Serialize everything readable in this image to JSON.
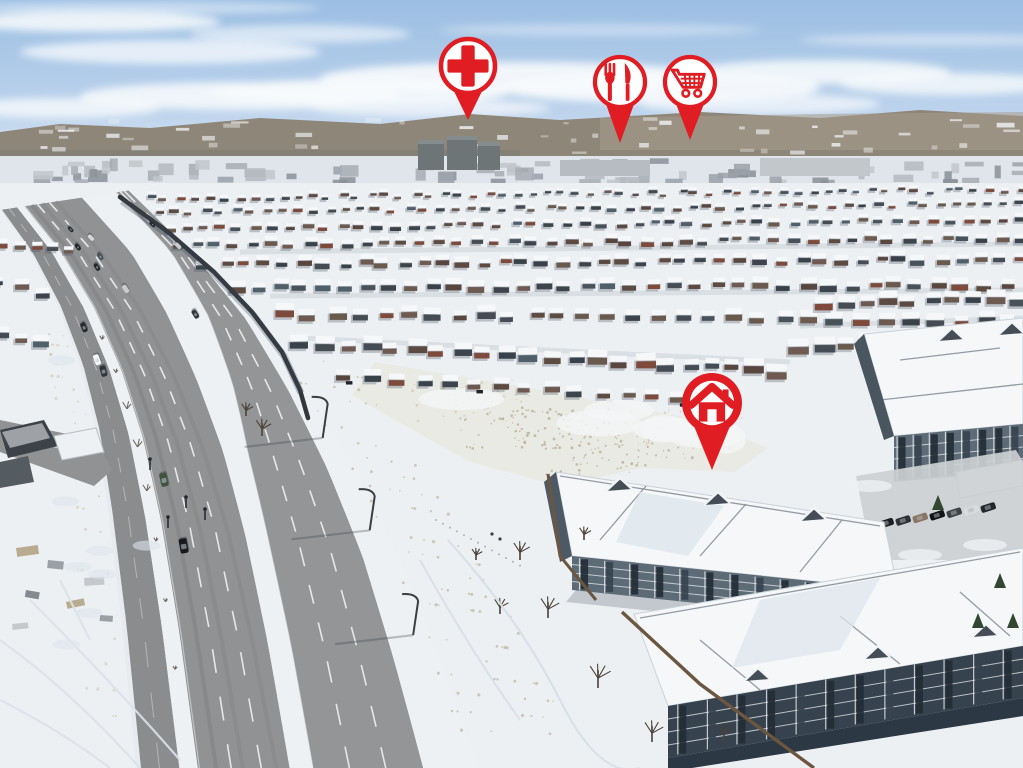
{
  "scene": {
    "type": "aerial-drone-photo",
    "description": "Winter aerial view of a snow-covered suburban neighbourhood: a multi-lane divided arterial road runs diagonally on the left, dense rows of snow-capped houses fill the midground below distant hills, an open snowy field sits in the centre, and three-storey condominium buildings occupy the lower right. Red location marker pins highlight nearby amenities and the featured home.",
    "season": "winter",
    "sky": "clear blue with thin white clouds"
  },
  "overlay": {
    "pin_color": "#e01d23",
    "pin_inner_color": "#ffffff",
    "pins": [
      {
        "name": "hospital-pin",
        "icon": "medical-cross-icon",
        "cx": 468,
        "cy": 66,
        "r": 27,
        "tip_y": 120,
        "style": "outline"
      },
      {
        "name": "restaurant-pin",
        "icon": "fork-knife-icon",
        "cx": 620,
        "cy": 82,
        "r": 25,
        "tip_y": 143,
        "style": "outline"
      },
      {
        "name": "grocery-pin",
        "icon": "shopping-cart-icon",
        "cx": 690,
        "cy": 82,
        "r": 25,
        "tip_y": 140,
        "style": "outline"
      },
      {
        "name": "home-pin",
        "icon": "house-icon",
        "cx": 712,
        "cy": 403,
        "r": 30,
        "tip_y": 470,
        "style": "filled"
      }
    ]
  },
  "palette": {
    "sky_top": "#9bbee3",
    "sky_bottom": "#d6e4f2",
    "cloud": "#f8fbfd",
    "hills": "#8e8678",
    "hills_far": "#a79d8c",
    "city_band": "#dfe5eb",
    "tower": "#6e7576",
    "snow": "#edf0f3",
    "snow_shadow": "#dde4ec",
    "road": "#909294",
    "collector_road": "#8a8c8e",
    "lane_marking": "#f4f6f8",
    "sound_wall": "#33373b",
    "roof_snow": "#f5f7f9",
    "field_grass": "#b5ad90",
    "condo_wall": "#5d6b77",
    "condo_wall_dark": "#36424e",
    "condo_glass": "#222c35",
    "condo_trim": "#e7ebee",
    "fence_wood": "#6b5640",
    "tree_bare": "#4a4138",
    "tree_evergreen": "#31472f"
  }
}
